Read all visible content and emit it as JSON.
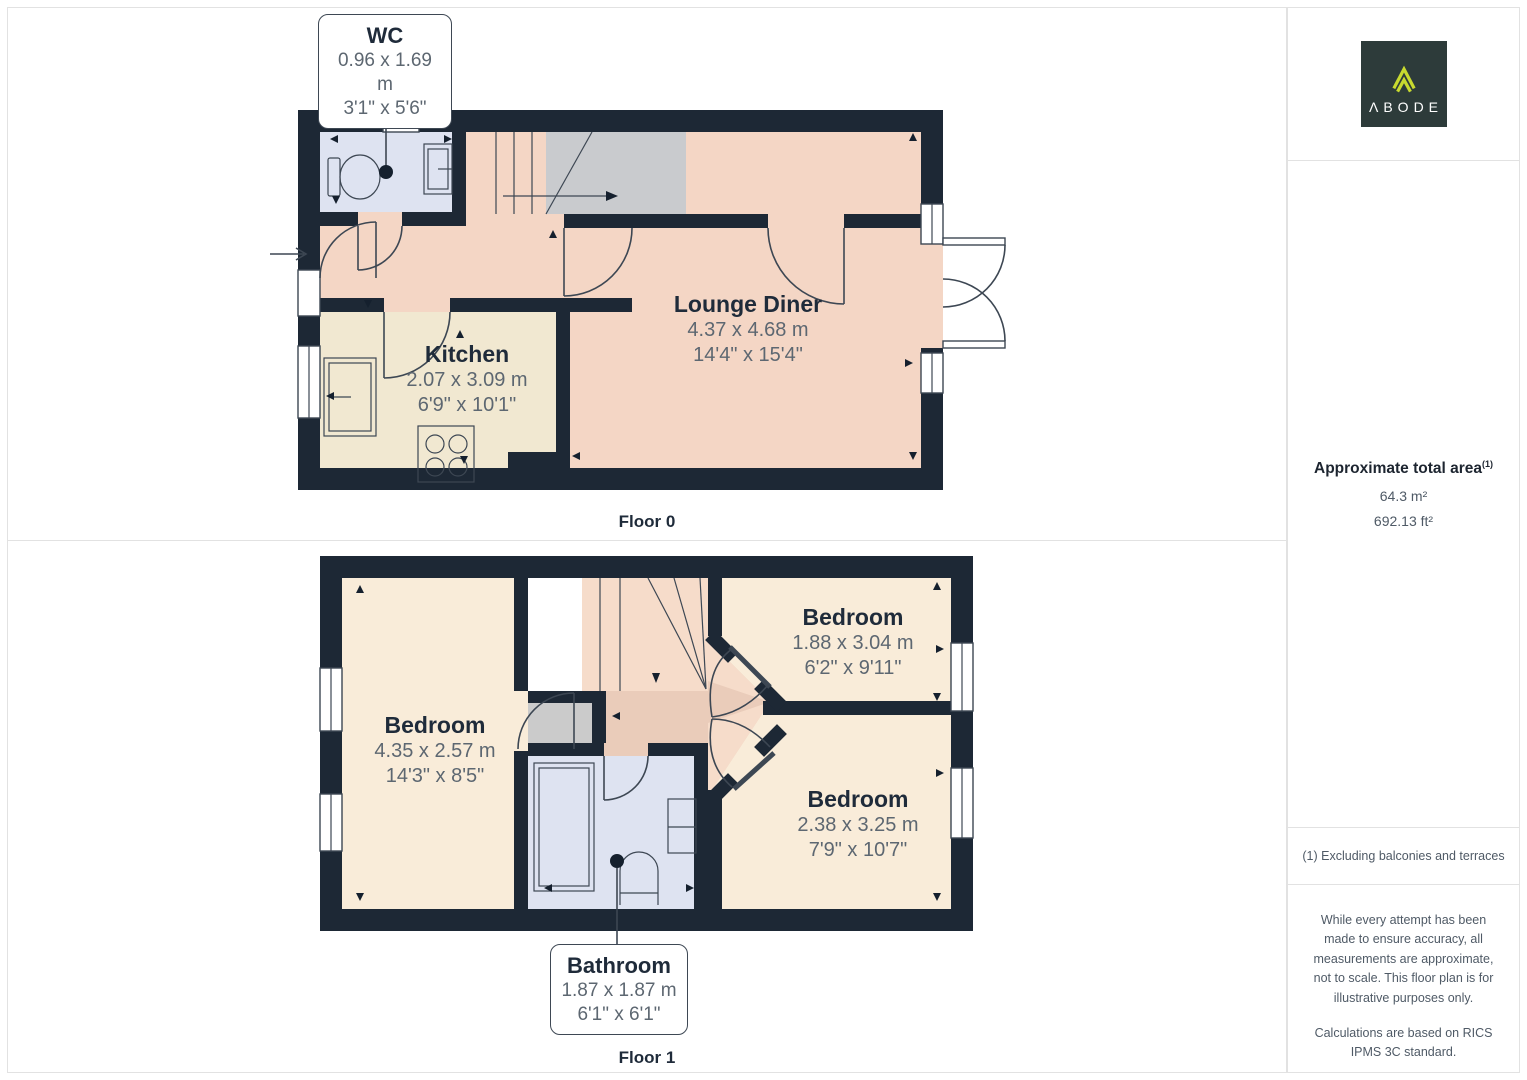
{
  "floors": [
    {
      "label": "Floor 0",
      "callout": {
        "name": "WC",
        "metric": "0.96 x 1.69 m",
        "imperial": "3'1\" x 5'6\""
      },
      "rooms": [
        {
          "name": "Kitchen",
          "metric": "2.07 x 3.09 m",
          "imperial": "6'9\" x 10'1\""
        },
        {
          "name": "Lounge Diner",
          "metric": "4.37 x 4.68 m",
          "imperial": "14'4\" x 15'4\""
        }
      ]
    },
    {
      "label": "Floor 1",
      "callout": {
        "name": "Bathroom",
        "metric": "1.87 x 1.87 m",
        "imperial": "6'1\" x 6'1\""
      },
      "rooms": [
        {
          "name": "Bedroom",
          "metric": "4.35 x 2.57 m",
          "imperial": "14'3\" x 8'5\""
        },
        {
          "name": "Bedroom",
          "metric": "1.88 x 3.04 m",
          "imperial": "6'2\" x 9'11\""
        },
        {
          "name": "Bedroom",
          "metric": "2.38 x 3.25 m",
          "imperial": "7'9\" x 10'7\""
        }
      ]
    }
  ],
  "sidebar": {
    "logo_text": "ΛBODE",
    "area_title": "Approximate total area",
    "area_superscript": "(1)",
    "area_m2": "64.3 m²",
    "area_ft2": "692.13 ft²",
    "footnote": "(1) Excluding balconies and terraces",
    "disclaimer_1": "While every attempt has been made to ensure accuracy, all measurements are approximate, not to scale. This floor plan is for illustrative purposes only.",
    "disclaimer_2": "Calculations are based on RICS IPMS 3C standard.",
    "brand": "GIRAFFE",
    "brand_bold": "360"
  },
  "colors": {
    "wall": "#1d2835",
    "line": "#3d4753",
    "pink": "#f4d6c5",
    "pink-dark": "#eaccba",
    "pink-light": "#f6dcca",
    "cream": "#f9ecd9",
    "kitchen": "#f1e8d1",
    "blue": "#dee3f1",
    "gray": "#c9cbce",
    "logo-bg": "#2d3b3a",
    "logo-lime": "#c8da2f"
  }
}
